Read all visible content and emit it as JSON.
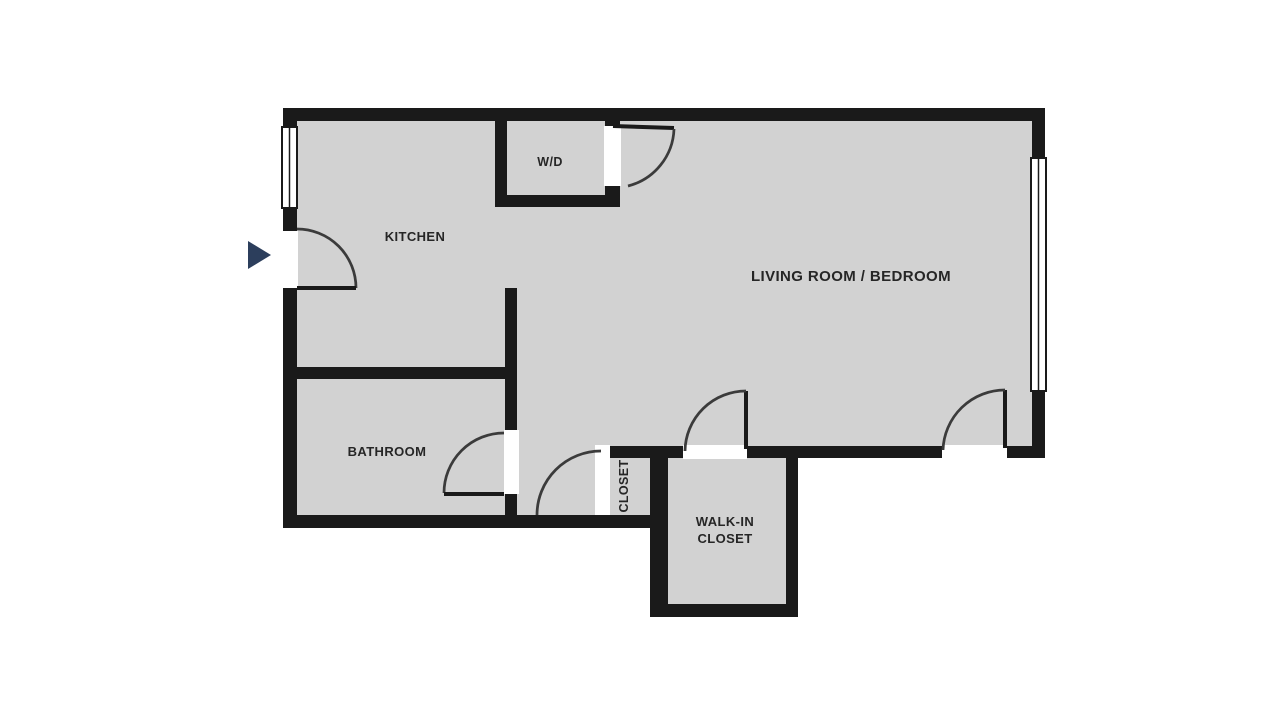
{
  "plan": {
    "labels": {
      "kitchen": "KITCHEN",
      "wd": "W/D",
      "living_room": "LIVING ROOM / BEDROOM",
      "bathroom": "BATHROOM",
      "closet": "CLOSET",
      "walkin_line1": "WALK-IN",
      "walkin_line2": "CLOSET"
    },
    "icons": {
      "entry_arrow": "entry-direction-arrow"
    },
    "colors": {
      "wall": "#1a1a1a",
      "floor": "#d2d2d2",
      "background": "#ffffff",
      "entry_arrow": "#2c3e5c",
      "door_arc": "#3b3b3b",
      "text": "#262626"
    }
  }
}
